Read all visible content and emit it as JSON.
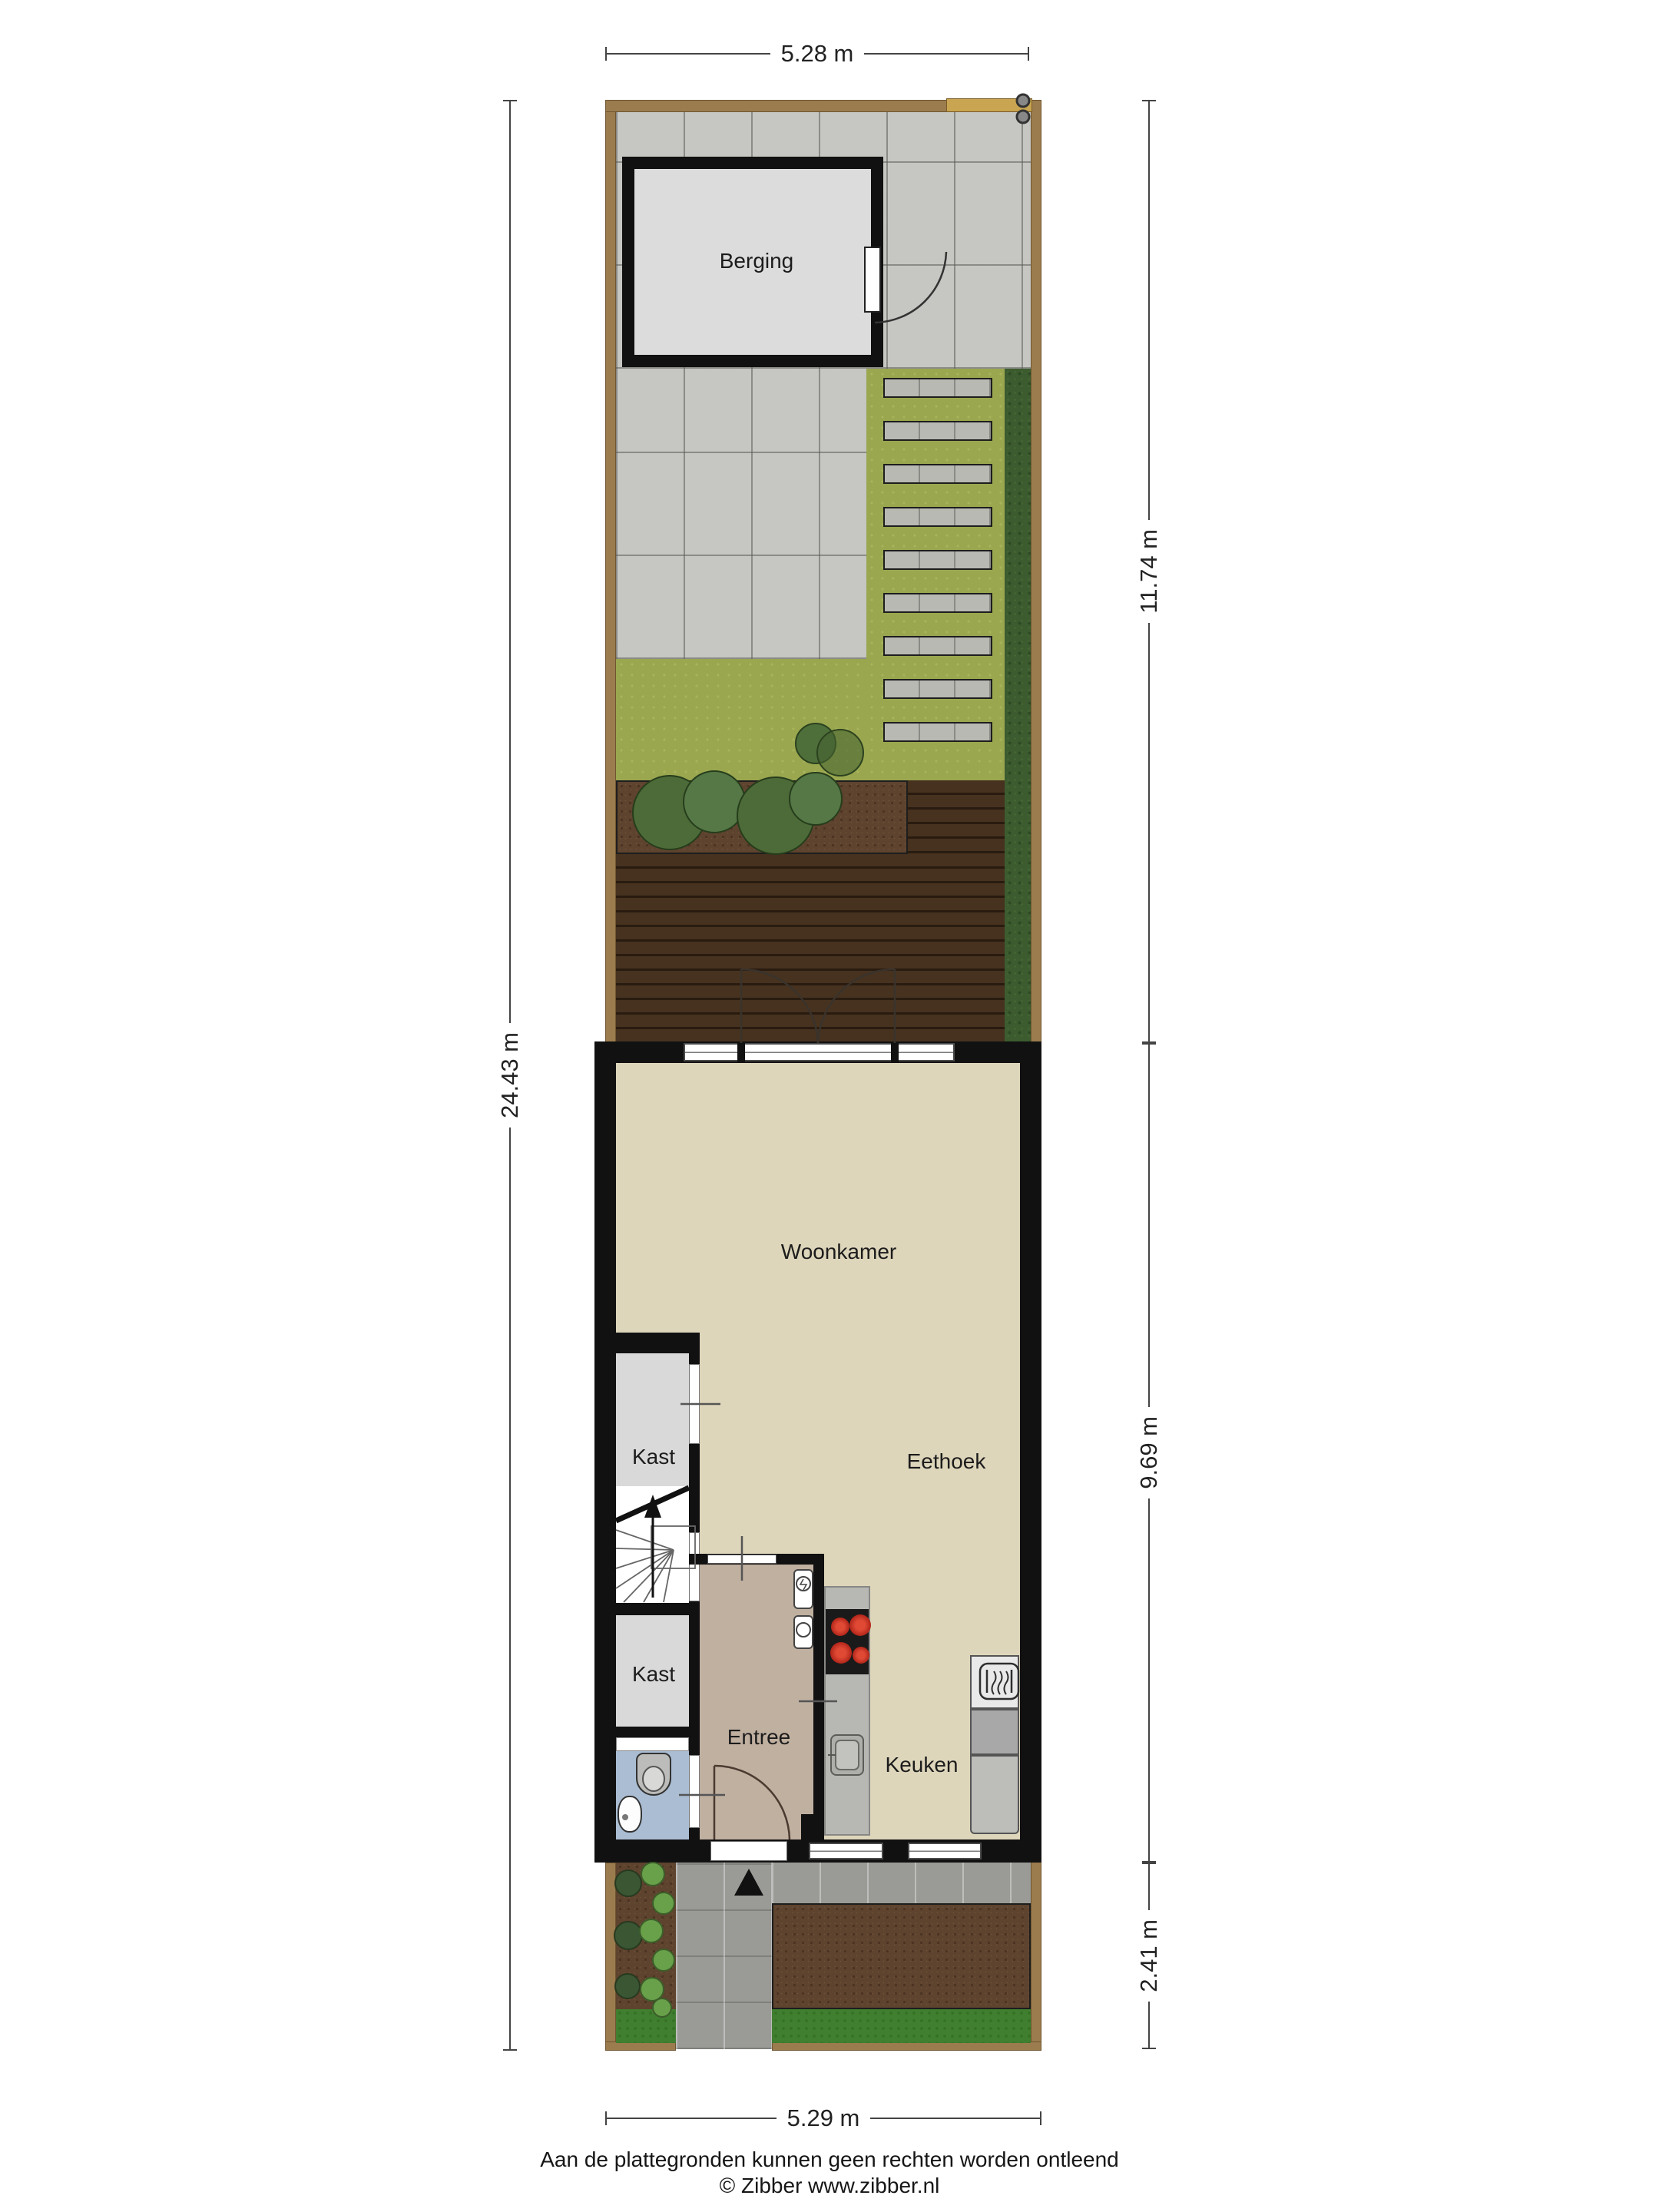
{
  "plan": {
    "rooms": {
      "berging": "Berging",
      "woonkamer": "Woonkamer",
      "eethoek": "Eethoek",
      "kast1": "Kast",
      "kast2": "Kast",
      "entree": "Entree",
      "keuken": "Keuken"
    },
    "dimensions": {
      "top": "5.28 m",
      "bottom": "5.29 m",
      "left": "24.43 m",
      "right_top": "11.74 m",
      "right_middle": "9.69 m",
      "right_bottom": "2.41 m"
    },
    "footer": {
      "disclaimer": "Aan de plattegronden kunnen geen rechten worden ontleend",
      "copyright": "© Zibber www.zibber.nl"
    },
    "colors": {
      "wall": "#111111",
      "fence": "#9b7c4e",
      "gate": "#c9a551",
      "paving": "#c6c6c2",
      "grass": "#9aa74f",
      "front_lawn": "#3f7f2f",
      "hedge": "#3c5c2f",
      "deck": "#46321f",
      "soil": "#5e432e",
      "floor": "#ded6bb",
      "entree_floor": "#c0b0a0",
      "closet_floor": "#d9d9d9",
      "toilet_floor": "#aabdd3",
      "counter": "#b7b7b4",
      "burner_red": "#cc2b22"
    },
    "stepping_stones": 9
  }
}
